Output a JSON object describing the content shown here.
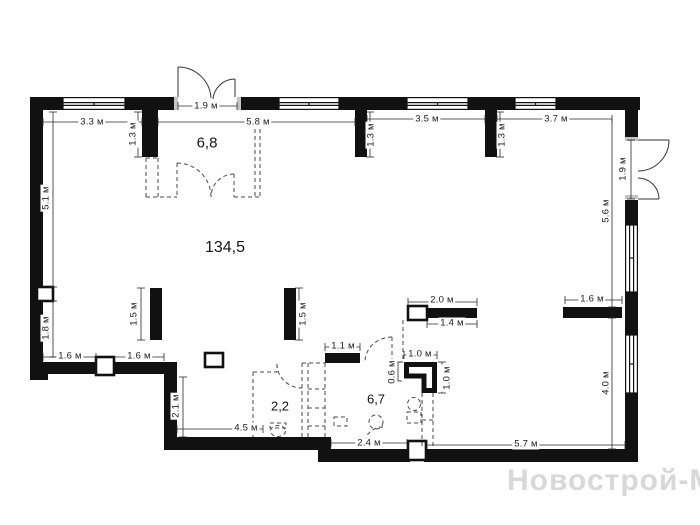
{
  "watermark": "Новострой-М",
  "rooms": [
    {
      "area": "6,8"
    },
    {
      "area": "134,5"
    },
    {
      "area": "2,2"
    },
    {
      "area": "6,7"
    }
  ],
  "dims": [
    {
      "text": "3.3 м"
    },
    {
      "text": "5.8 м"
    },
    {
      "text": "3.5 м"
    },
    {
      "text": "3.7 м"
    },
    {
      "text": "1.9 м"
    },
    {
      "text": "1.6 м"
    },
    {
      "text": "1.6 м"
    },
    {
      "text": "4.5 м"
    },
    {
      "text": "2.1 м"
    },
    {
      "text": "1.3 м"
    },
    {
      "text": "1.3 м"
    },
    {
      "text": "1.3 м"
    },
    {
      "text": "5.1 м"
    },
    {
      "text": "1.8 м"
    },
    {
      "text": "1.5 м"
    },
    {
      "text": "1.5 м"
    },
    {
      "text": "1.1 м"
    },
    {
      "text": "2.0 м"
    },
    {
      "text": "1.4 м"
    },
    {
      "text": "1.0 м"
    },
    {
      "text": "0.6 м"
    },
    {
      "text": "1.0 м"
    },
    {
      "text": "1.6 м"
    },
    {
      "text": "5.6 м"
    },
    {
      "text": "4.0 м"
    },
    {
      "text": "1.9 м"
    },
    {
      "text": "2.4 м"
    },
    {
      "text": "5.7 м"
    }
  ],
  "colors": {
    "wall": "#111111",
    "dash": "#4a4a4a",
    "dimline": "#2a2a2a",
    "watermark": "#d8d8d8"
  }
}
